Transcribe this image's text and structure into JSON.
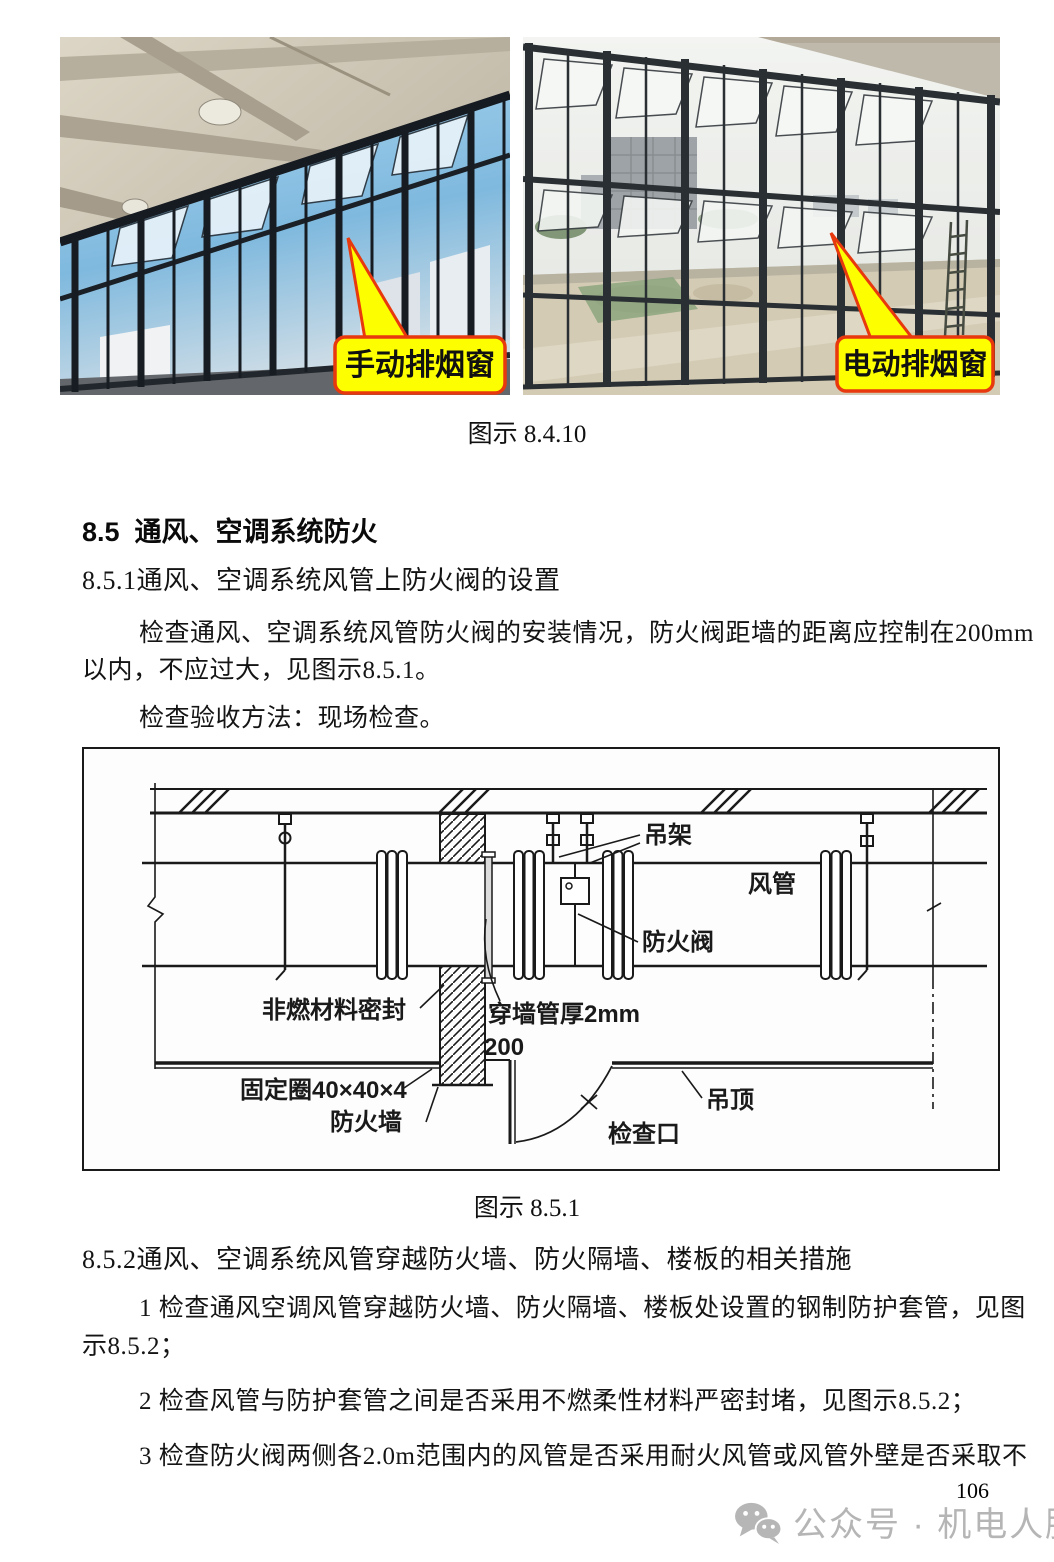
{
  "page": {
    "caption_fig_8410": "图示 8.4.10",
    "heading_85": "8.5  通风、空调系统防火",
    "heading_851": "8.5.1通风、空调系统风管上防火阀的设置",
    "para_851_l1": "检查通风、空调系统风管防火阀的安装情况，防火阀距墙的距离应控制在200mm",
    "para_851_l2": "以内，不应过大，见图示8.5.1。",
    "para_851_method": "检查验收方法：现场检查。",
    "caption_fig_851": "图示 8.5.1",
    "heading_852": "8.5.2通风、空调系统风管穿越防火墙、防火隔墙、楼板的相关措施",
    "para_852_1a": "1 检查通风空调风管穿越防火墙、防火隔墙、楼板处设置的钢制防护套管，见图",
    "para_852_1b": "示8.5.2；",
    "para_852_2": "2 检查风管与防护套管之间是否采用不燃柔性材料严密封堵，见图示8.5.2；",
    "para_852_3": "3 检查防火阀两侧各2.0m范围内的风管是否采用耐火风管或风管外壁是否采取不",
    "page_number": "106",
    "watermark": "公众号 · 机电人脉"
  },
  "photos": {
    "left_callout": "手动排烟窗",
    "right_callout": "电动排烟窗"
  },
  "diagram": {
    "label_hanger": "吊架",
    "label_duct": "风管",
    "label_fire_damper": "防火阀",
    "label_seal": "非燃材料密封",
    "label_sleeve": "穿墙管厚2mm",
    "label_dim200": "200",
    "label_fixing_ring": "固定圈40×40×4",
    "label_fire_wall": "防火墙",
    "label_ceiling": "吊顶",
    "label_inspection": "检查口"
  },
  "colors": {
    "callout_fill": "#fdff00",
    "callout_border": "#e8380d",
    "watermark_gray": "#b5b5b5"
  }
}
